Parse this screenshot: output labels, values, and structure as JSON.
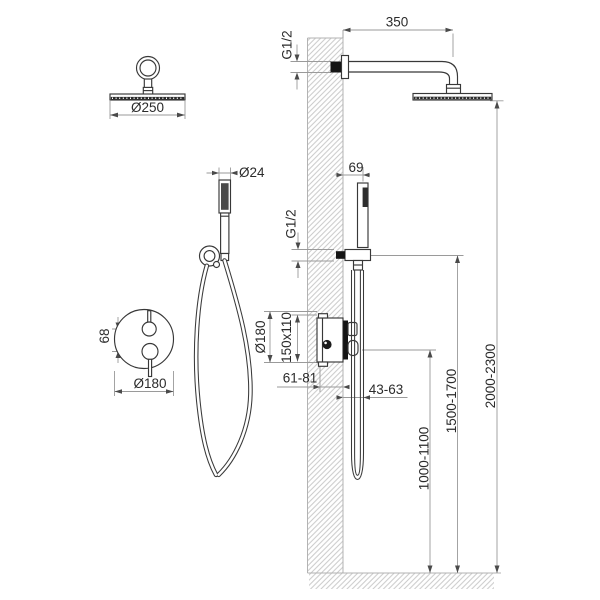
{
  "labels": {
    "rain_head_diameter": "Ø250",
    "hand_shower_diameter": "Ø24",
    "mixer_handle_spacing": "68",
    "mixer_plate_diameter_front": "Ø180",
    "arm_length": "350",
    "arm_thread": "G1/2",
    "rain_head_mounting_height": "2000-2300",
    "hand_shower_offset": "69",
    "hand_shower_thread": "G1/2",
    "hand_shower_mounting_height": "1500-1700",
    "mixer_plate_diameter_side": "Ø180",
    "rough_in_box_size": "150x110",
    "rough_in_depth": "61-81",
    "handle_projection": "43-63",
    "mixer_mounting_height": "1000-1100"
  },
  "colors": {
    "background": "#ffffff",
    "fixture_line": "#383838",
    "dimension_line": "#9a9a9a",
    "arrow": "#4a4a4a",
    "hatch": "#c9c9c9",
    "text": "#2b2b2b"
  }
}
